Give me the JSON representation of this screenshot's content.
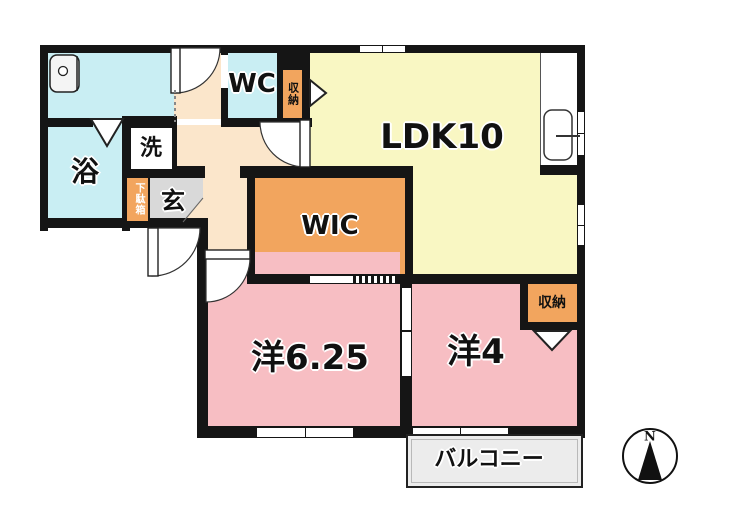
{
  "rooms": {
    "ldk": "LDK10",
    "wic": "WIC",
    "western_6_25": "洋6.25",
    "western_4": "洋4",
    "bath": "浴",
    "laundry": "洗",
    "wc": "WC",
    "entrance": "玄",
    "shoe_cabinet": "下駄箱",
    "hall_storage": "収納",
    "bedroom_storage": "収納",
    "balcony": "バルコニー"
  },
  "compass": {
    "north": "N"
  },
  "colors": {
    "wet_area": "#c9eef3",
    "living": "#f9f7c3",
    "closet": "#f2a55e",
    "bedroom": "#f7bec3",
    "hallway": "#fbe6cb",
    "entrance_floor": "#d9d9d9",
    "balcony": "#ececec",
    "wall": "#151515"
  }
}
